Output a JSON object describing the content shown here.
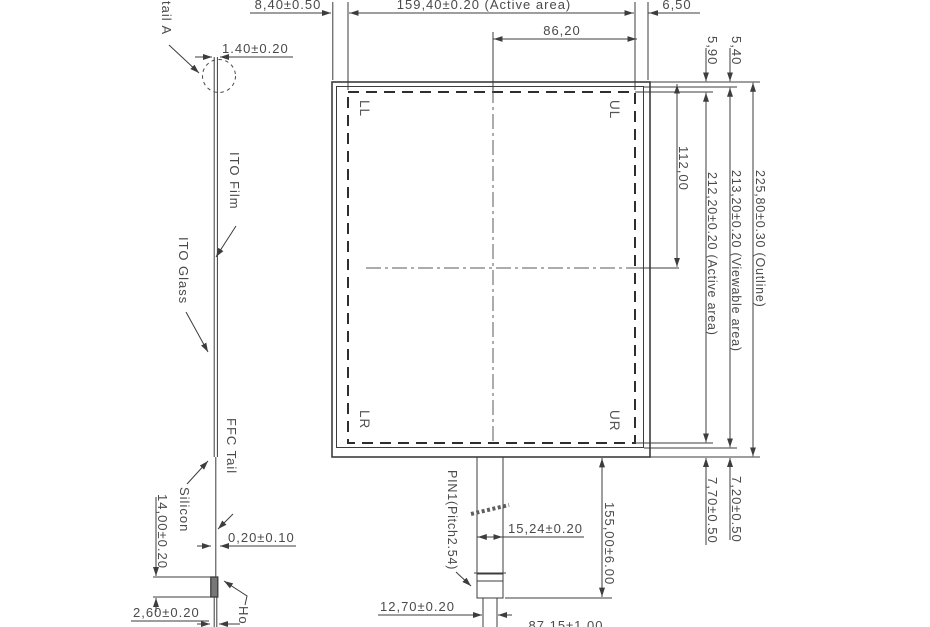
{
  "front_view": {
    "corners": {
      "ll": "LL",
      "ul": "UL",
      "lr": "LR",
      "ur": "UR"
    },
    "dim_left_margin": "8,40±0.50",
    "dim_active_width": "159,40±0.20 (Active area)",
    "dim_right_margin": "6,50",
    "dim_center_right": "86,20",
    "dim_top_active": "5,90",
    "dim_top_viewable": "5,40",
    "dim_center_top": "112,00",
    "dim_active_height": "212,20±0.20 (Active area)",
    "dim_viewable_height": "213,20±0.20 (Viewable area)",
    "dim_outline_height": "225,80±0.30 (Outline)",
    "dim_bottom_active": "7,70±0.50",
    "dim_bottom_viewable": "7,20±0.50",
    "dim_tail_length": "155,00±6.00",
    "dim_tail_width": "15,24±0.20",
    "dim_pin_span": "12,70±0.20",
    "dim_tail_offset": "87,15±1.00",
    "label_pin1": "PIN1(Pitch2.54)"
  },
  "side_view": {
    "label_detail": "tail A",
    "label_ito_film": "ITO Film",
    "label_ito_glass": "ITO Glass",
    "label_ffc_tail": "FFC Tail",
    "label_silicon": "Silicon",
    "label_hot_bar": "Ho",
    "dim_thickness": "1.40±0.20",
    "dim_film_thickness": "0,20±0.10",
    "dim_stiffener": "14,00±0.20",
    "dim_connector_thickness": "2,60±0.20"
  },
  "colors": {
    "line": "#3d3d3d",
    "text": "#4a4a4a",
    "background": "#ffffff"
  }
}
